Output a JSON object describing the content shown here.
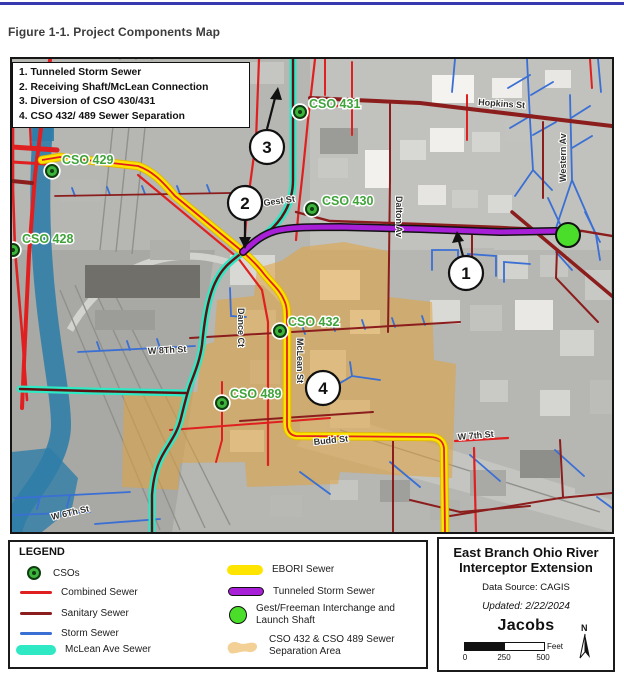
{
  "page": {
    "figure_title": "Figure 1-1. Project Components Map"
  },
  "map": {
    "callout_items": [
      "1. Tunneled Storm Sewer",
      "2. Receiving Shaft/McLean Connection",
      "3. Diversion of CSO 430/431",
      "4. CSO 432/ 489 Sewer Separation"
    ],
    "cso_points": [
      {
        "label": "CSO 428"
      },
      {
        "label": "CSO 429"
      },
      {
        "label": "CSO 430"
      },
      {
        "label": "CSO 431"
      },
      {
        "label": "CSO 432"
      },
      {
        "label": "CSO 489"
      }
    ],
    "streets": [
      {
        "label": "Hopkins St"
      },
      {
        "label": "Western Av"
      },
      {
        "label": "Gest St"
      },
      {
        "label": "Dalton Av"
      },
      {
        "label": "Dance Ct"
      },
      {
        "label": "McLean St"
      },
      {
        "label": "W 8Th St"
      },
      {
        "label": "Budd St"
      },
      {
        "label": "W 7th St"
      },
      {
        "label": "W 6Th St"
      }
    ],
    "numbered_markers": [
      {
        "label": "1"
      },
      {
        "label": "2"
      },
      {
        "label": "3"
      },
      {
        "label": "4"
      }
    ]
  },
  "legend": {
    "title": "LEGEND",
    "left_items": [
      {
        "label": "CSOs"
      },
      {
        "label": "Combined Sewer"
      },
      {
        "label": "Sanitary Sewer"
      },
      {
        "label": "Storm Sewer"
      },
      {
        "label": "McLean Ave Sewer"
      }
    ],
    "right_items": [
      {
        "label": "EBORI Sewer"
      },
      {
        "label": "Tunneled Storm Sewer"
      },
      {
        "label_line1": "Gest/Freeman Interchange and",
        "label_line2": "Launch Shaft"
      },
      {
        "label_line1": "CSO 432 & CSO 489 Sewer",
        "label_line2": "Separation Area"
      }
    ]
  },
  "title_box": {
    "title_line1": "East Branch Ohio River",
    "title_line2": "Interceptor Extension",
    "data_source": "Data Source: CAGIS",
    "updated": "Updated: 2/22/2024",
    "logo": "Jacobs",
    "scale": {
      "tick0": "0",
      "tick1": "250",
      "tick2": "500",
      "unit": "Feet"
    },
    "north": "N"
  },
  "colors": {
    "accent_rule": "#3838b0",
    "ebori_yellow": "#ffe400",
    "tunnel_purple": "#a81fd8",
    "mclean_teal": "#2fe8c4",
    "cso_green": "#3db53d",
    "shaft_green": "#4ade2a",
    "combined_red": "#e02020",
    "sanitary_dark_red": "#8b1d1d",
    "storm_blue": "#3a6fd4",
    "separation_tan": "#e0a33c",
    "river_blue": "#2e7da8",
    "label_green": "#3fa33a"
  }
}
